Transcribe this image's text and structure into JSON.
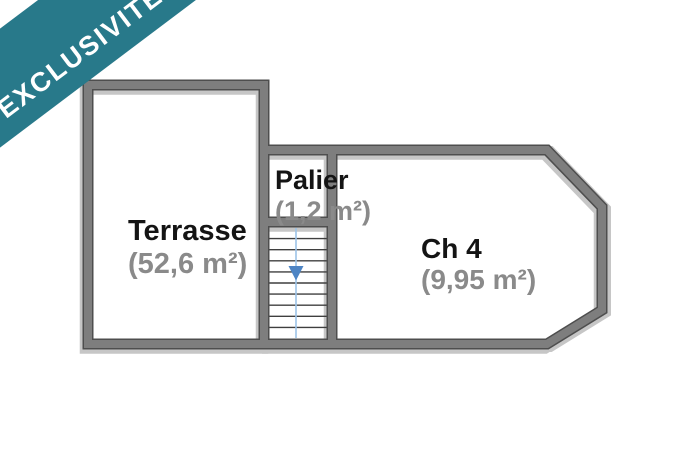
{
  "banner": {
    "label": "EXCLUSIVITÉ"
  },
  "plan": {
    "rooms": [
      {
        "id": "terrasse",
        "name": "Terrasse",
        "area": "(52,6 m²)"
      },
      {
        "id": "palier",
        "name": "Palier",
        "area": "(1,2 m²)"
      },
      {
        "id": "ch4",
        "name": "Ch 4",
        "area": "(9,95 m²)"
      }
    ],
    "stairs": {
      "steps": 10,
      "direction": "down"
    },
    "colors": {
      "banner": "#28798a",
      "banner_text": "#ffffff",
      "wall_fill": "#7e7e7e",
      "wall_edge": "#4e4e4e",
      "wall_shadow": "#c6c6c6",
      "room_name": "#141414",
      "room_area": "#8a8a8a",
      "stair_line": "#9cc3e8",
      "stair_arrow": "#4d84c4",
      "step_line": "#3f3f3f"
    }
  }
}
